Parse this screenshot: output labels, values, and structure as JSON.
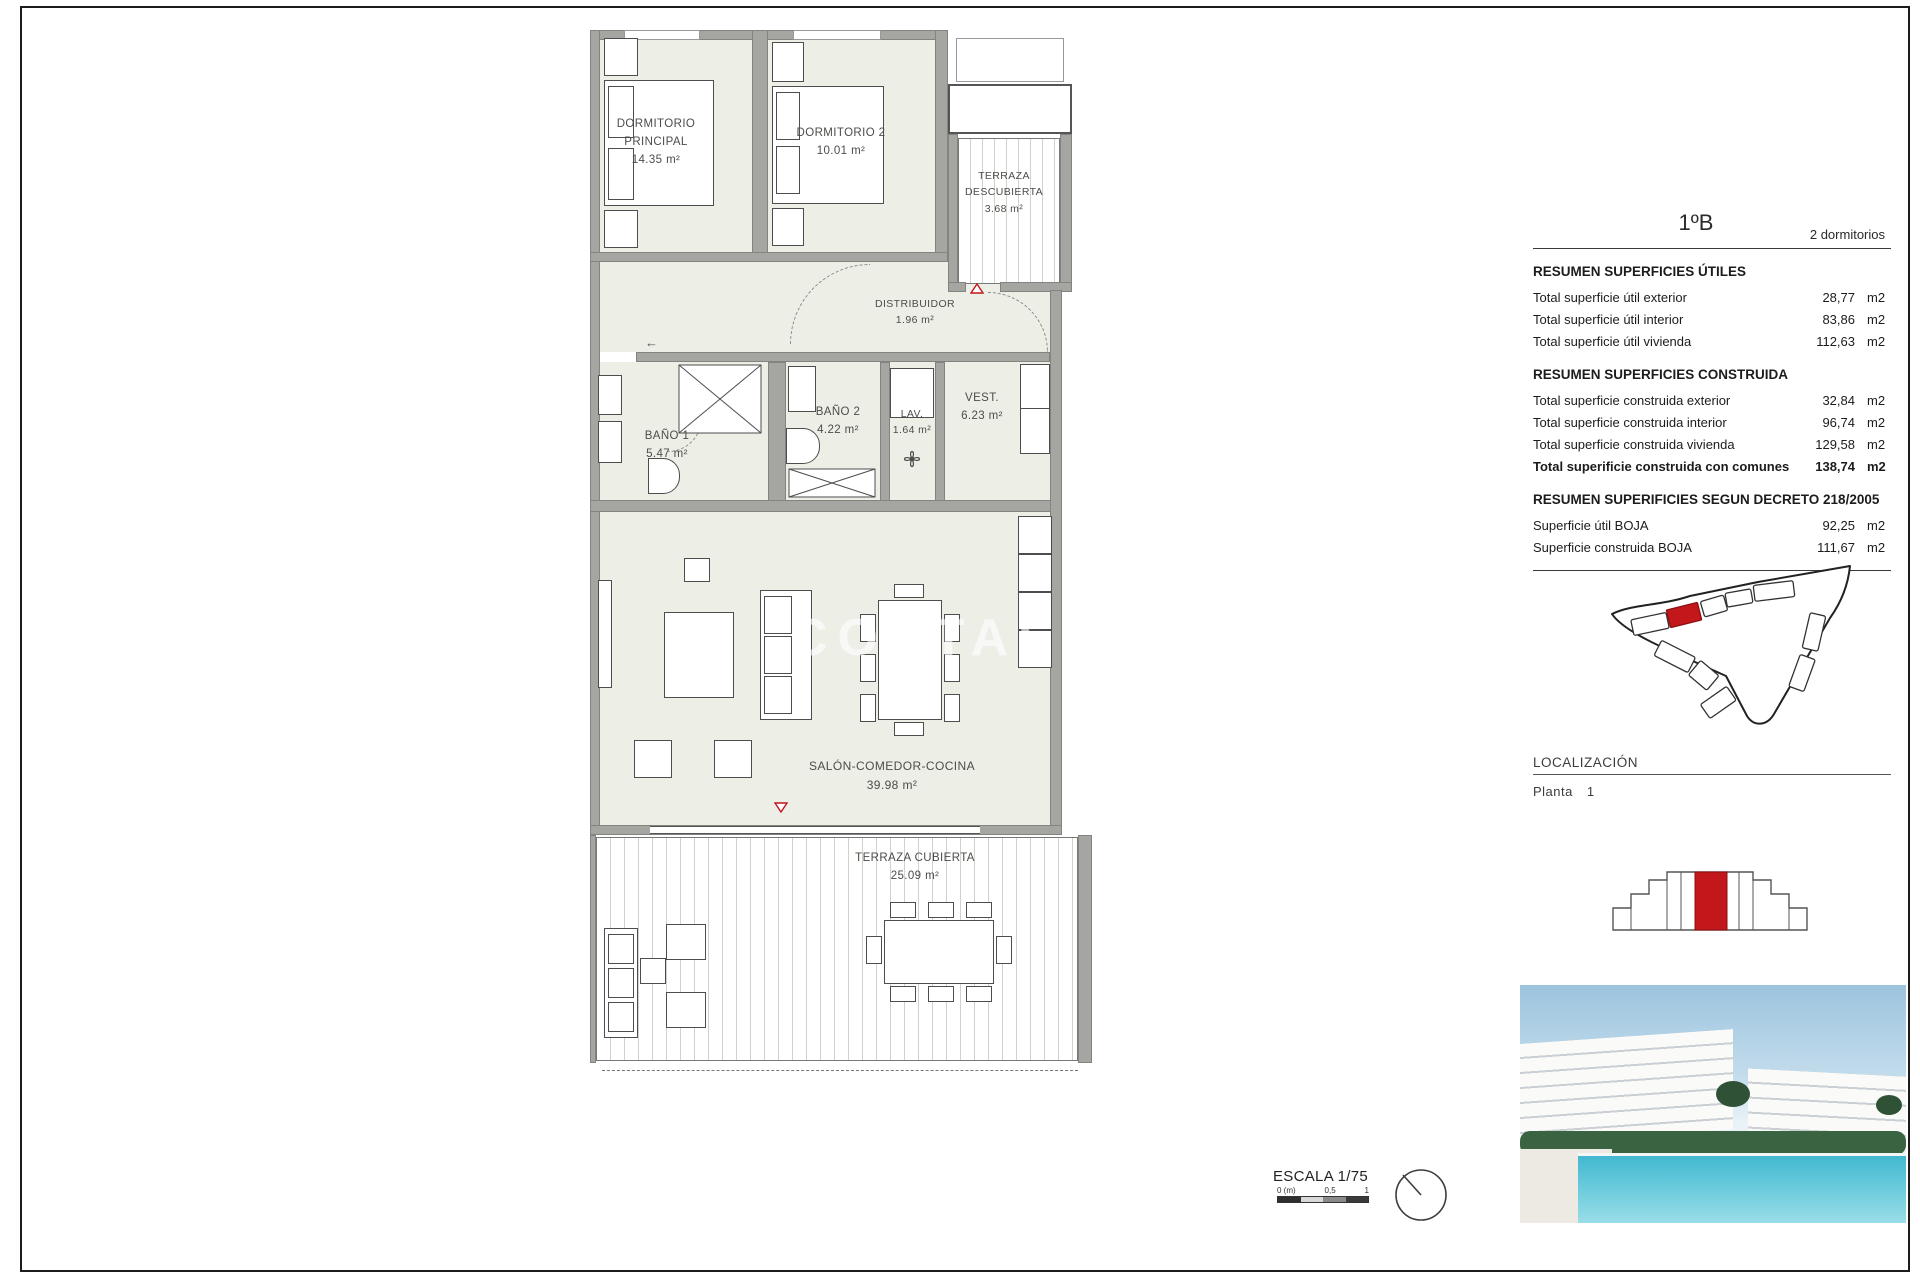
{
  "sheet": {
    "watermark": "COSTAS",
    "scale": {
      "label": "ESCALA 1/75",
      "tick0": "0 (m)",
      "tick05": "0,5",
      "tick1": "1"
    }
  },
  "icons": {
    "left_arrow": "←"
  },
  "plan": {
    "rooms": [
      {
        "name": "DORMITORIO\nPRINCIPAL",
        "area": "14.35 m²"
      },
      {
        "name": "DORMITORIO 2",
        "area": "10.01 m²"
      },
      {
        "name": "TERRAZA\nDESCUBIERTA",
        "area": "3.68 m²"
      },
      {
        "name": "DISTRIBUIDOR",
        "area": "1.96 m²"
      },
      {
        "name": "BAÑO 1",
        "area": "5.47 m²"
      },
      {
        "name": "BAÑO 2",
        "area": "4.22 m²"
      },
      {
        "name": "LAV.",
        "area": "1.64 m²"
      },
      {
        "name": "VEST.",
        "area": "6.23 m²"
      },
      {
        "name": "SALÓN-COMEDOR-COCINA",
        "area": "39.98 m²"
      },
      {
        "name": "TERRAZA CUBIERTA",
        "area": "25.09 m²"
      }
    ]
  },
  "summary": {
    "unit_code": "1ºB",
    "unit_type": "2 dormitorios",
    "sections": [
      {
        "title": "RESUMEN SUPERFICIES ÚTILES",
        "rows": [
          {
            "label": "Total superficie útil exterior",
            "value": "28,77",
            "unit": "m2"
          },
          {
            "label": "Total superficie útil interior",
            "value": "83,86",
            "unit": "m2"
          },
          {
            "label": "Total superficie útil vivienda",
            "value": "112,63",
            "unit": "m2"
          }
        ]
      },
      {
        "title": "RESUMEN SUPERFICIES CONSTRUIDA",
        "rows": [
          {
            "label": "Total superficie construida exterior",
            "value": "32,84",
            "unit": "m2"
          },
          {
            "label": "Total superficie construida interior",
            "value": "96,74",
            "unit": "m2"
          },
          {
            "label": "Total superficie construida vivienda",
            "value": "129,58",
            "unit": "m2"
          },
          {
            "label": "Total superificie construida con comunes",
            "value": "138,74",
            "unit": "m2"
          }
        ]
      },
      {
        "title": "RESUMEN SUPERIFICIES SEGUN DECRETO 218/2005",
        "rows": [
          {
            "label": "Superficie útil BOJA",
            "value": "92,25",
            "unit": "m2"
          },
          {
            "label": "Superficie construida BOJA",
            "value": "111,67",
            "unit": "m2"
          }
        ]
      }
    ]
  },
  "localizacion": {
    "title": "LOCALIZACIÓN",
    "floor_label": "Planta",
    "floor_number": "1"
  },
  "colors": {
    "accent_red": "#c2171b",
    "room_fill": "#edefe7",
    "wall_gray": "#a5a5a2"
  }
}
